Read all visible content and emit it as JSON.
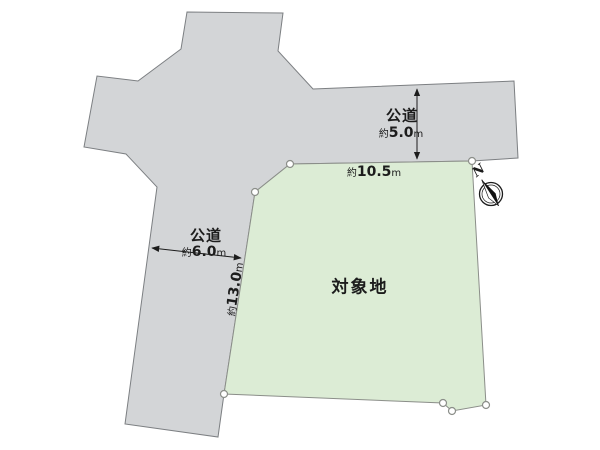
{
  "title": "土地区画図",
  "colors": {
    "road_fill": "#d3d5d7",
    "road_stroke": "#7c7f82",
    "plot_fill": "#dcecd5",
    "plot_stroke": "#8b8e89",
    "text": "#1c1c1c"
  },
  "roads": {
    "north_road": {
      "label": "公道"
    },
    "west_road": {
      "label": "公道"
    }
  },
  "plot": {
    "label": "対象地"
  },
  "dimensions": {
    "north_road_width": {
      "prefix": "約",
      "value": "5.0",
      "unit": "m"
    },
    "north_frontage": {
      "prefix": "約",
      "value": "10.5",
      "unit": "m"
    },
    "west_road_width": {
      "prefix": "約",
      "value": "6.0",
      "unit": "m"
    },
    "west_frontage": {
      "prefix": "約",
      "value": "13.0",
      "unit": "m"
    }
  },
  "compass": {
    "label": "N"
  }
}
